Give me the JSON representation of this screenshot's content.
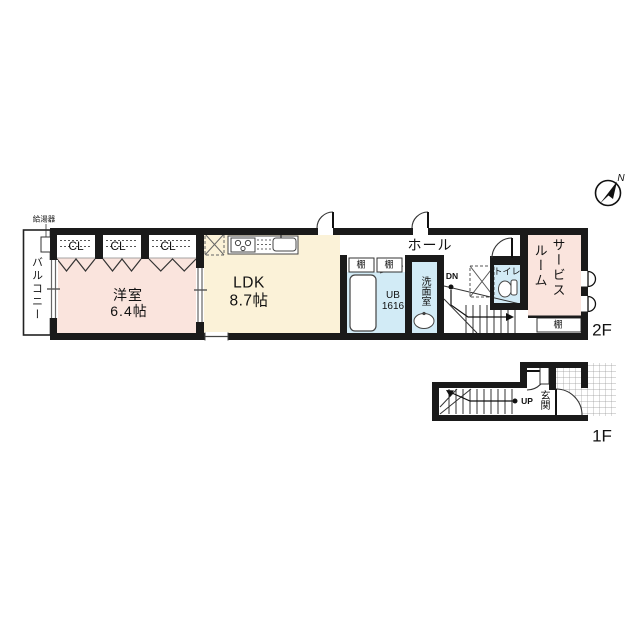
{
  "title": "maisonette-floor-plan",
  "colors": {
    "wall": "#1a1a1a",
    "room_pink": "#fae4dd",
    "room_cream": "#fbf2d8",
    "room_blue": "#d2ebf6",
    "line": "#444444"
  },
  "compass": {
    "north_label": "N"
  },
  "floor2": {
    "floor_label": "2F",
    "balcony_label": "バルコニー",
    "water_heater_label": "給湯器",
    "closets": [
      "CL",
      "CL",
      "CL"
    ],
    "western_room": {
      "name": "洋室",
      "size": "6.4帖"
    },
    "ldk": {
      "name": "LDK",
      "size": "8.7帖"
    },
    "hall_label": "ホール",
    "shelves": [
      "棚",
      "棚",
      "棚"
    ],
    "unit_bath": {
      "line1": "UB",
      "line2": "1616"
    },
    "washroom_label": "洗面室",
    "stairs_down_label": "DN",
    "toilet_label": "トイレ",
    "service_room": {
      "col1": "サービス",
      "col2": "ルーム"
    }
  },
  "floor1": {
    "floor_label": "1F",
    "entrance_label": "玄関",
    "stairs_up_label": "UP"
  }
}
